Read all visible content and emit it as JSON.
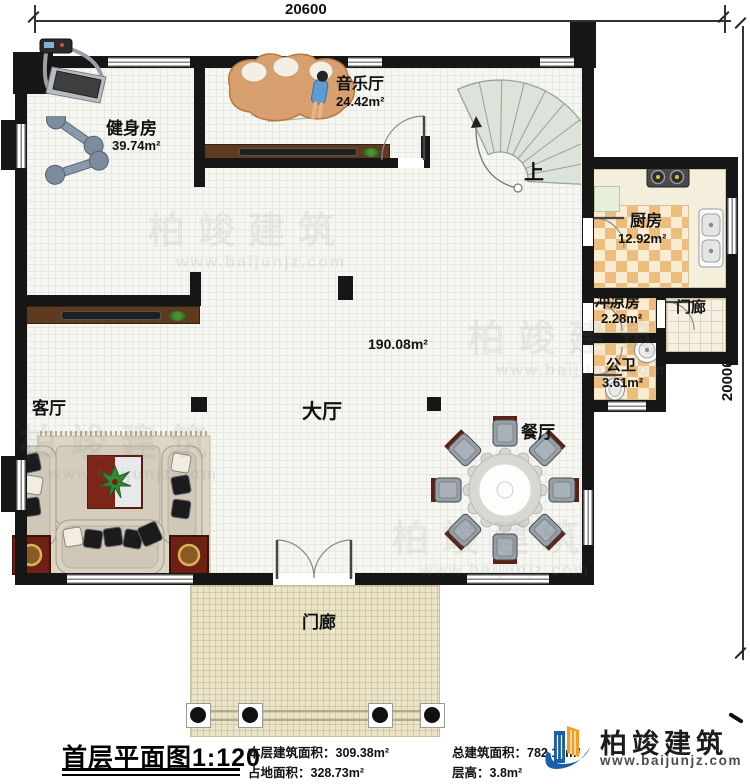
{
  "dimensions": {
    "top_width": "20600",
    "right_height": "20000"
  },
  "rooms": {
    "gym": {
      "name": "健身房",
      "area": "39.74m²"
    },
    "music": {
      "name": "音乐厅",
      "area": "24.42m²"
    },
    "kitchen": {
      "name": "厨房",
      "area": "12.92m²"
    },
    "shower": {
      "name": "冲凉房",
      "area": "2.28m²"
    },
    "toilet": {
      "name": "公卫",
      "area": "3.61m²"
    },
    "hall": {
      "name": "大厅",
      "area": "190.08m²"
    },
    "living": {
      "name": "客厅"
    },
    "dining": {
      "name": "餐厅"
    },
    "porch_right": {
      "name": "门廊"
    },
    "porch_front": {
      "name": "门廊"
    },
    "stair": {
      "direction_label": "上"
    }
  },
  "title_block": {
    "plan_title": "首层平面图",
    "plan_scale": "1:120",
    "stats": [
      {
        "label": "本层建筑面积：",
        "value": "309.38m²"
      },
      {
        "label": "总建筑面积：",
        "value": "782.16m²"
      },
      {
        "label": "占地面积：",
        "value": "328.73m²"
      },
      {
        "label": "层高：",
        "value": "3.8m²"
      }
    ],
    "brand": {
      "name": "柏竣建筑",
      "website": "www.baijunjz.com"
    }
  },
  "watermark": {
    "text": "柏竣建筑",
    "website": "www.baijunjz.com"
  },
  "colors": {
    "wall": "#161616",
    "checker_tile": "#ecbd7d",
    "brand_blue": "#1b5fa8",
    "brand_orange": "#f59d1f",
    "stair_fill": "#dce3d8"
  }
}
